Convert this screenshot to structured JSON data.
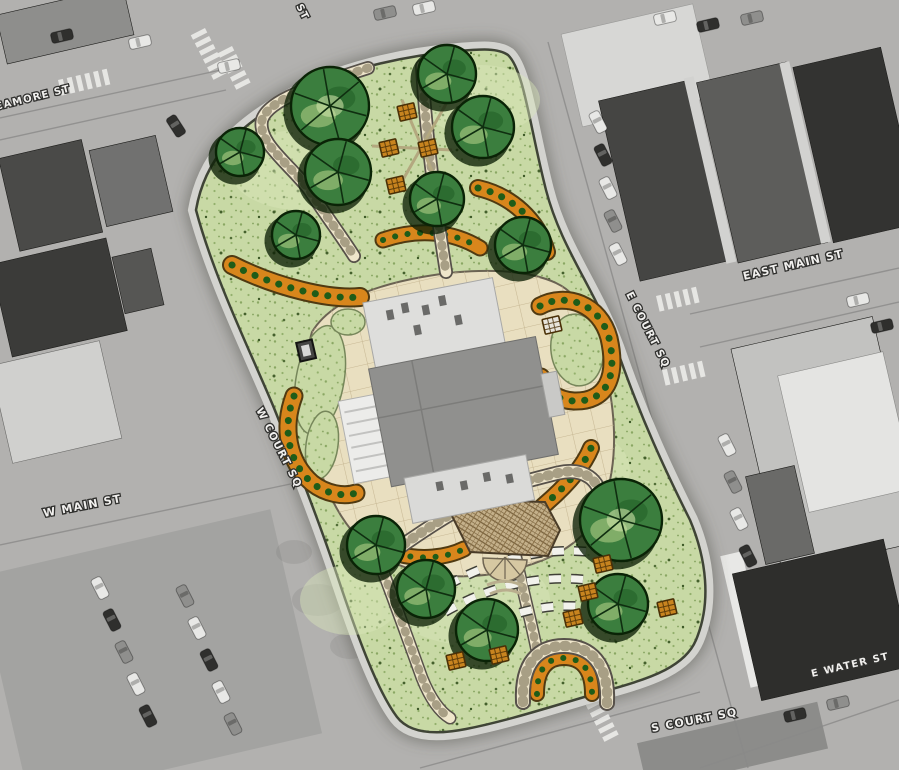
{
  "meta": {
    "description": "Landscape master plan rendering of a courthouse square overlaid on a grayscale aerial photograph of the surrounding downtown blocks"
  },
  "streets": {
    "labels": [
      {
        "id": "sycamore-st",
        "text": "CAMORE ST",
        "x": -4,
        "y": 110,
        "rot": -14,
        "size": 10
      },
      {
        "id": "st-partial",
        "text": "ST",
        "x": 296,
        "y": 6,
        "rot": 63,
        "size": 10
      },
      {
        "id": "east-main-st",
        "text": "EAST MAIN ST",
        "x": 744,
        "y": 280,
        "rot": -13,
        "size": 11
      },
      {
        "id": "e-court-sq",
        "text": "E COURT SQ",
        "x": 626,
        "y": 294,
        "rot": 63,
        "size": 10.5
      },
      {
        "id": "w-court-sq",
        "text": "W COURT SQ",
        "x": 256,
        "y": 410,
        "rot": 63,
        "size": 10.5
      },
      {
        "id": "w-main-st",
        "text": "W MAIN ST",
        "x": 44,
        "y": 517,
        "rot": -11,
        "size": 11
      },
      {
        "id": "e-water-st",
        "text": "E WATER ST",
        "x": 812,
        "y": 677,
        "rot": -13,
        "size": 10
      },
      {
        "id": "s-court-sq",
        "text": "S COURT SQ",
        "x": 652,
        "y": 732,
        "rot": -11,
        "size": 11
      }
    ]
  },
  "site": {
    "trees": [
      {
        "x": 240,
        "y": 152,
        "r": 24
      },
      {
        "x": 330,
        "y": 106,
        "r": 39
      },
      {
        "x": 338,
        "y": 172,
        "r": 33
      },
      {
        "x": 447,
        "y": 74,
        "r": 29
      },
      {
        "x": 483,
        "y": 127,
        "r": 31
      },
      {
        "x": 437,
        "y": 199,
        "r": 27
      },
      {
        "x": 296,
        "y": 235,
        "r": 24
      },
      {
        "x": 523,
        "y": 245,
        "r": 28
      },
      {
        "x": 376,
        "y": 545,
        "r": 29
      },
      {
        "x": 426,
        "y": 589,
        "r": 29
      },
      {
        "x": 487,
        "y": 630,
        "r": 31
      },
      {
        "x": 621,
        "y": 520,
        "r": 41
      },
      {
        "x": 618,
        "y": 604,
        "r": 30
      }
    ],
    "benches": [
      {
        "x": 407,
        "y": 112
      },
      {
        "x": 389,
        "y": 148
      },
      {
        "x": 428,
        "y": 148
      },
      {
        "x": 396,
        "y": 185
      },
      {
        "x": 603,
        "y": 564
      },
      {
        "x": 588,
        "y": 592
      },
      {
        "x": 573,
        "y": 618
      },
      {
        "x": 667,
        "y": 608
      },
      {
        "x": 456,
        "y": 661
      },
      {
        "x": 499,
        "y": 655
      },
      {
        "x": 552,
        "y": 325,
        "c": "#e8e5dc"
      }
    ],
    "colors": {
      "lawn": "#c8d9a5",
      "tree": "#3b7e3e",
      "planting_bed": "#d8861c",
      "walkway": "#efe6cb",
      "plaza": "#e9dfc0",
      "pergola": "#c4b08a"
    }
  },
  "aerial": {
    "colors": {
      "road": "#b2b1af",
      "building_dark": "#3b3b39",
      "building_light": "#d7d7d5"
    },
    "cars": [
      {
        "x": 100,
        "y": 588,
        "rot": 63,
        "c": "w"
      },
      {
        "x": 112,
        "y": 620,
        "rot": 63,
        "c": "d"
      },
      {
        "x": 124,
        "y": 652,
        "rot": 63,
        "c": "g"
      },
      {
        "x": 136,
        "y": 684,
        "rot": 63,
        "c": "w"
      },
      {
        "x": 148,
        "y": 716,
        "rot": 63,
        "c": "d"
      },
      {
        "x": 185,
        "y": 596,
        "rot": 63,
        "c": "g"
      },
      {
        "x": 197,
        "y": 628,
        "rot": 63,
        "c": "w"
      },
      {
        "x": 209,
        "y": 660,
        "rot": 63,
        "c": "d"
      },
      {
        "x": 221,
        "y": 692,
        "rot": 63,
        "c": "w"
      },
      {
        "x": 233,
        "y": 724,
        "rot": 63,
        "c": "g"
      },
      {
        "x": 140,
        "y": 42,
        "rot": -13,
        "c": "w"
      },
      {
        "x": 62,
        "y": 36,
        "rot": -13,
        "c": "d"
      },
      {
        "x": 176,
        "y": 126,
        "rot": 57,
        "c": "d"
      },
      {
        "x": 229,
        "y": 66,
        "rot": -13,
        "c": "w"
      },
      {
        "x": 385,
        "y": 13,
        "rot": -13,
        "c": "g"
      },
      {
        "x": 424,
        "y": 8,
        "rot": -13,
        "c": "w"
      },
      {
        "x": 598,
        "y": 122,
        "rot": 63,
        "c": "w"
      },
      {
        "x": 603,
        "y": 155,
        "rot": 63,
        "c": "d"
      },
      {
        "x": 608,
        "y": 188,
        "rot": 63,
        "c": "w"
      },
      {
        "x": 613,
        "y": 221,
        "rot": 63,
        "c": "g"
      },
      {
        "x": 618,
        "y": 254,
        "rot": 63,
        "c": "w"
      },
      {
        "x": 665,
        "y": 18,
        "rot": -13,
        "c": "w"
      },
      {
        "x": 708,
        "y": 25,
        "rot": -13,
        "c": "d"
      },
      {
        "x": 752,
        "y": 18,
        "rot": -13,
        "c": "g"
      },
      {
        "x": 858,
        "y": 300,
        "rot": -13,
        "c": "w"
      },
      {
        "x": 882,
        "y": 326,
        "rot": -13,
        "c": "d"
      },
      {
        "x": 727,
        "y": 445,
        "rot": 63,
        "c": "w"
      },
      {
        "x": 733,
        "y": 482,
        "rot": 63,
        "c": "g"
      },
      {
        "x": 739,
        "y": 519,
        "rot": 63,
        "c": "w"
      },
      {
        "x": 748,
        "y": 556,
        "rot": 63,
        "c": "d"
      },
      {
        "x": 795,
        "y": 715,
        "rot": -13,
        "c": "d"
      },
      {
        "x": 838,
        "y": 703,
        "rot": -13,
        "c": "g"
      }
    ],
    "crosswalks": [
      {
        "x": 58,
        "y": 80,
        "rot": -13,
        "n": 6
      },
      {
        "x": 205,
        "y": 28,
        "rot": 63,
        "n": 6
      },
      {
        "x": 232,
        "y": 46,
        "rot": 63,
        "n": 5
      },
      {
        "x": 656,
        "y": 296,
        "rot": -13,
        "n": 5
      },
      {
        "x": 662,
        "y": 370,
        "rot": -13,
        "n": 5
      },
      {
        "x": 596,
        "y": 690,
        "rot": 63,
        "n": 6
      }
    ]
  }
}
